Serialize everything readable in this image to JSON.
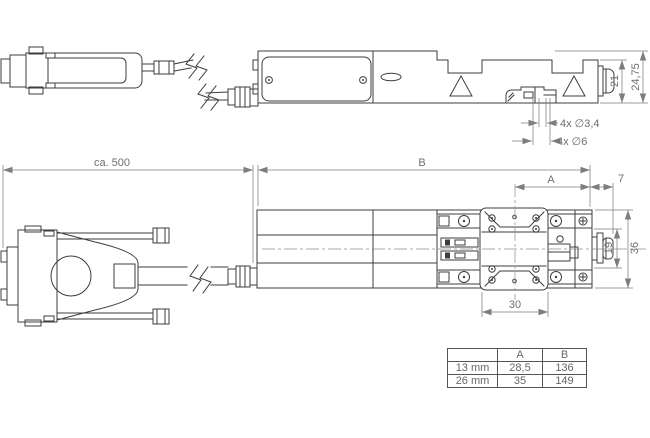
{
  "dims": {
    "ca500": "ca. 500",
    "b_label": "B",
    "a_label": "A",
    "seven": "7",
    "h21": "21",
    "h2475": "24,75",
    "holes_small": "4x ∅3,4",
    "holes_big": "4x ∅6",
    "v19": "19",
    "v36": "36",
    "w30": "30"
  },
  "table": {
    "col_a": "A",
    "col_b": "B",
    "rows": [
      {
        "label": "13 mm",
        "a": "28,5",
        "b": "136"
      },
      {
        "label": "26 mm",
        "a": "35",
        "b": "149"
      }
    ]
  },
  "colors": {
    "background": "#ffffff",
    "geometry": "#3d3d3d",
    "dimension": "#7d7d7d"
  }
}
